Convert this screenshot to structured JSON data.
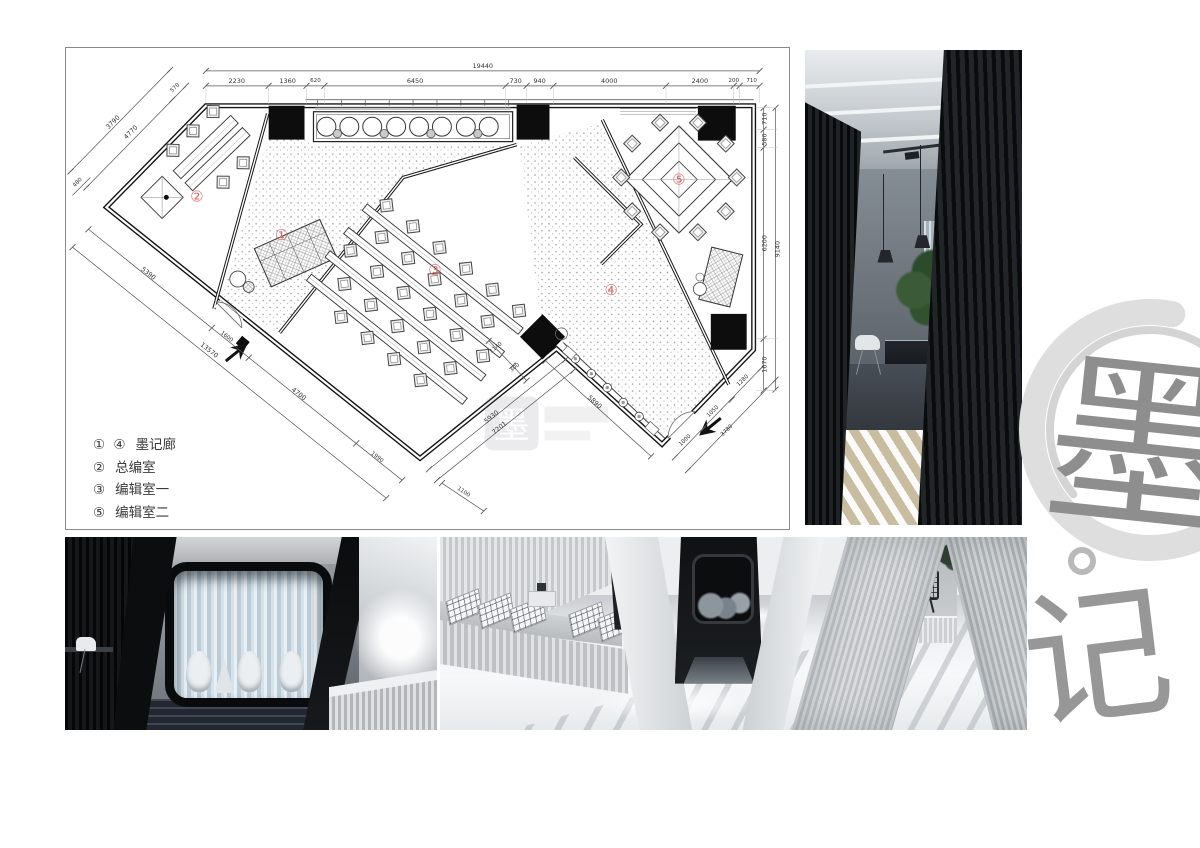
{
  "plan": {
    "dims": {
      "top_total": "19440",
      "top": [
        "2230",
        "1360",
        "620",
        "6450",
        "730",
        "940",
        "4000",
        "2400",
        "200",
        "710"
      ],
      "right": [
        "710",
        "580",
        "6200",
        "1670"
      ],
      "right_total": "9140",
      "left_edge": [
        "570",
        "4770",
        "3790",
        "480"
      ],
      "lower_left": [
        "5390",
        "1600",
        "4700",
        "1990"
      ],
      "lower_left_total": "13570",
      "wing_tip": "1100",
      "middle": [
        "5930",
        "7201",
        "5890",
        "1140",
        "300"
      ],
      "bottom_right": [
        "1000",
        "1050",
        "1280"
      ],
      "bottom_right_total": "3780"
    },
    "room_labels": [
      "①",
      "②",
      "③",
      "④",
      "⑤"
    ],
    "legend": [
      {
        "numbers": "① ④",
        "label": "墨记廊"
      },
      {
        "numbers": "②",
        "label": "总编室"
      },
      {
        "numbers": "③",
        "label": "编辑室一"
      },
      {
        "numbers": "⑤",
        "label": "编辑室二"
      }
    ]
  },
  "watermark": {
    "char": "墨"
  },
  "logo": {
    "char_top": "墨",
    "char_bottom": "记"
  },
  "colors": {
    "accent_red": "#d96a6a",
    "logo_gray": "#8e8e8e",
    "enso_gray": "#dedede"
  }
}
